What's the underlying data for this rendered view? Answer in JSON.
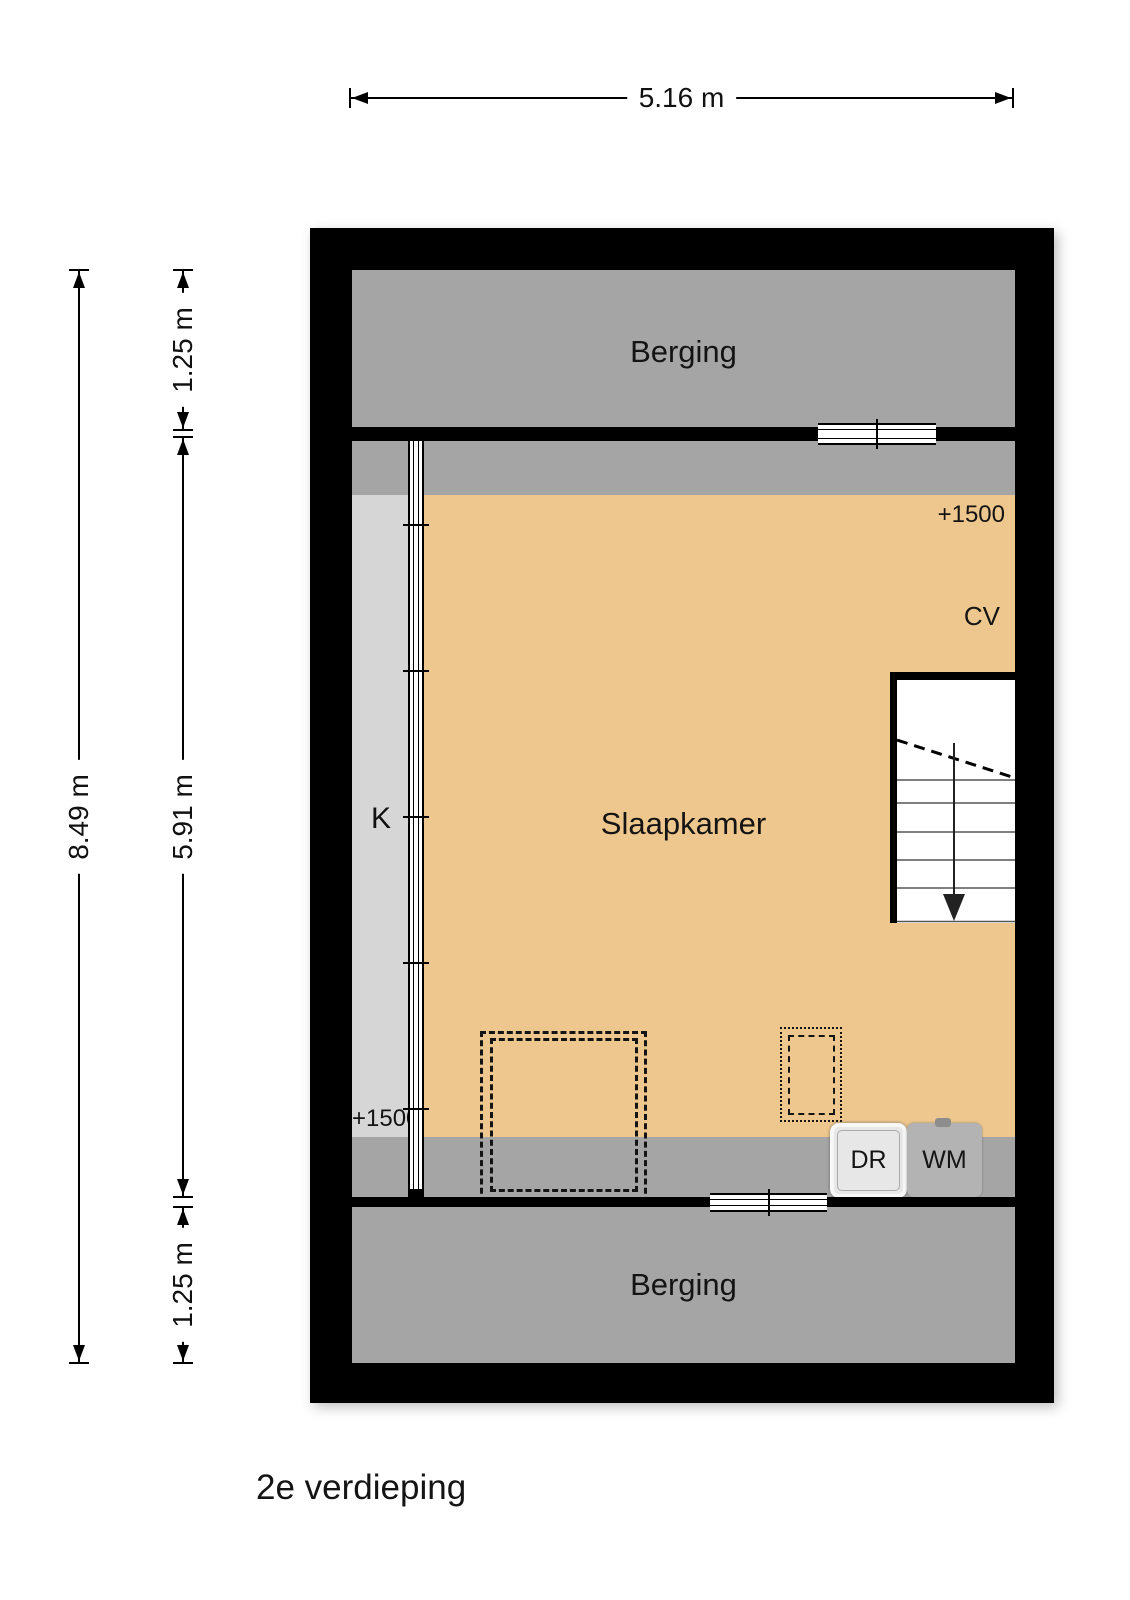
{
  "title": {
    "floor": "2e verdieping"
  },
  "dimensions": {
    "top": "5.16 m",
    "left_total": "8.49 m",
    "left_top": "1.25 m",
    "left_middle": "5.91 m",
    "left_bottom": "1.25 m"
  },
  "rooms": {
    "berging_top": {
      "label": "Berging"
    },
    "berging_bottom": {
      "label": "Berging"
    },
    "slaapkamer": {
      "label": "Slaapkamer"
    },
    "closet": {
      "label": "K"
    }
  },
  "annotations": {
    "height_marker_top": "+1500",
    "height_marker_bottom": "+1500",
    "cv": "CV"
  },
  "appliances": {
    "dryer": "DR",
    "washer": "WM"
  },
  "colors": {
    "wall": "#000000",
    "storage_gray": "#a5a5a5",
    "closet_gray": "#d6d6d6",
    "floor_tan": "#edc78d",
    "appliance_light": "#e7e7e7",
    "appliance_gray": "#b3b3b3"
  }
}
